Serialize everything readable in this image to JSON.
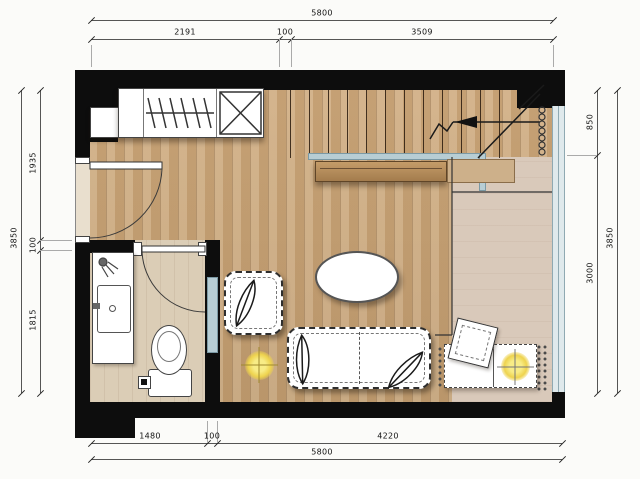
{
  "title": "studio-apartment-floor-plan",
  "dimensions": {
    "top": {
      "total": "5800",
      "seg1": "2191",
      "seg2": "100",
      "seg3": "3509"
    },
    "bottom": {
      "total": "5800",
      "seg1": "1480",
      "seg2": "100",
      "seg3": "4220"
    },
    "left": {
      "total": "3850",
      "seg1": "1935",
      "seg2": "100",
      "seg3": "1815"
    },
    "right": {
      "total": "3850",
      "seg1": "850",
      "seg2": "3000"
    }
  },
  "colors": {
    "wall": "#0d0d0d",
    "wood_floor": "#c9a87c",
    "bath_tile": "#dbcdb6",
    "understair_floor": "#d9c9ba",
    "glass_window": "#dfe9ec",
    "glass_frame": "#8fa9b2",
    "flower_yellow": "#eed34e",
    "furniture_outline": "#2e2e2e",
    "dimension_text": "#111111"
  },
  "symbols": {
    "closet": "wardrobe-with-hangers",
    "shaft": "x-crossed-box",
    "stairs": "staircase-up-arrow",
    "radiator": "coil-circles",
    "entry_door": "door-swing-arc",
    "bath_door": "door-swing-arc",
    "toilet": "toilet-top-view",
    "vanity": "sink-counter",
    "shower": "shower-head",
    "sofa": "two-seat-sofa-with-leaf-pillows",
    "armchair": "armchair-with-leaf-pillow",
    "table": "oval-table",
    "desk": "desk-with-rotated-chair",
    "plants": "yellow-round-plants"
  }
}
